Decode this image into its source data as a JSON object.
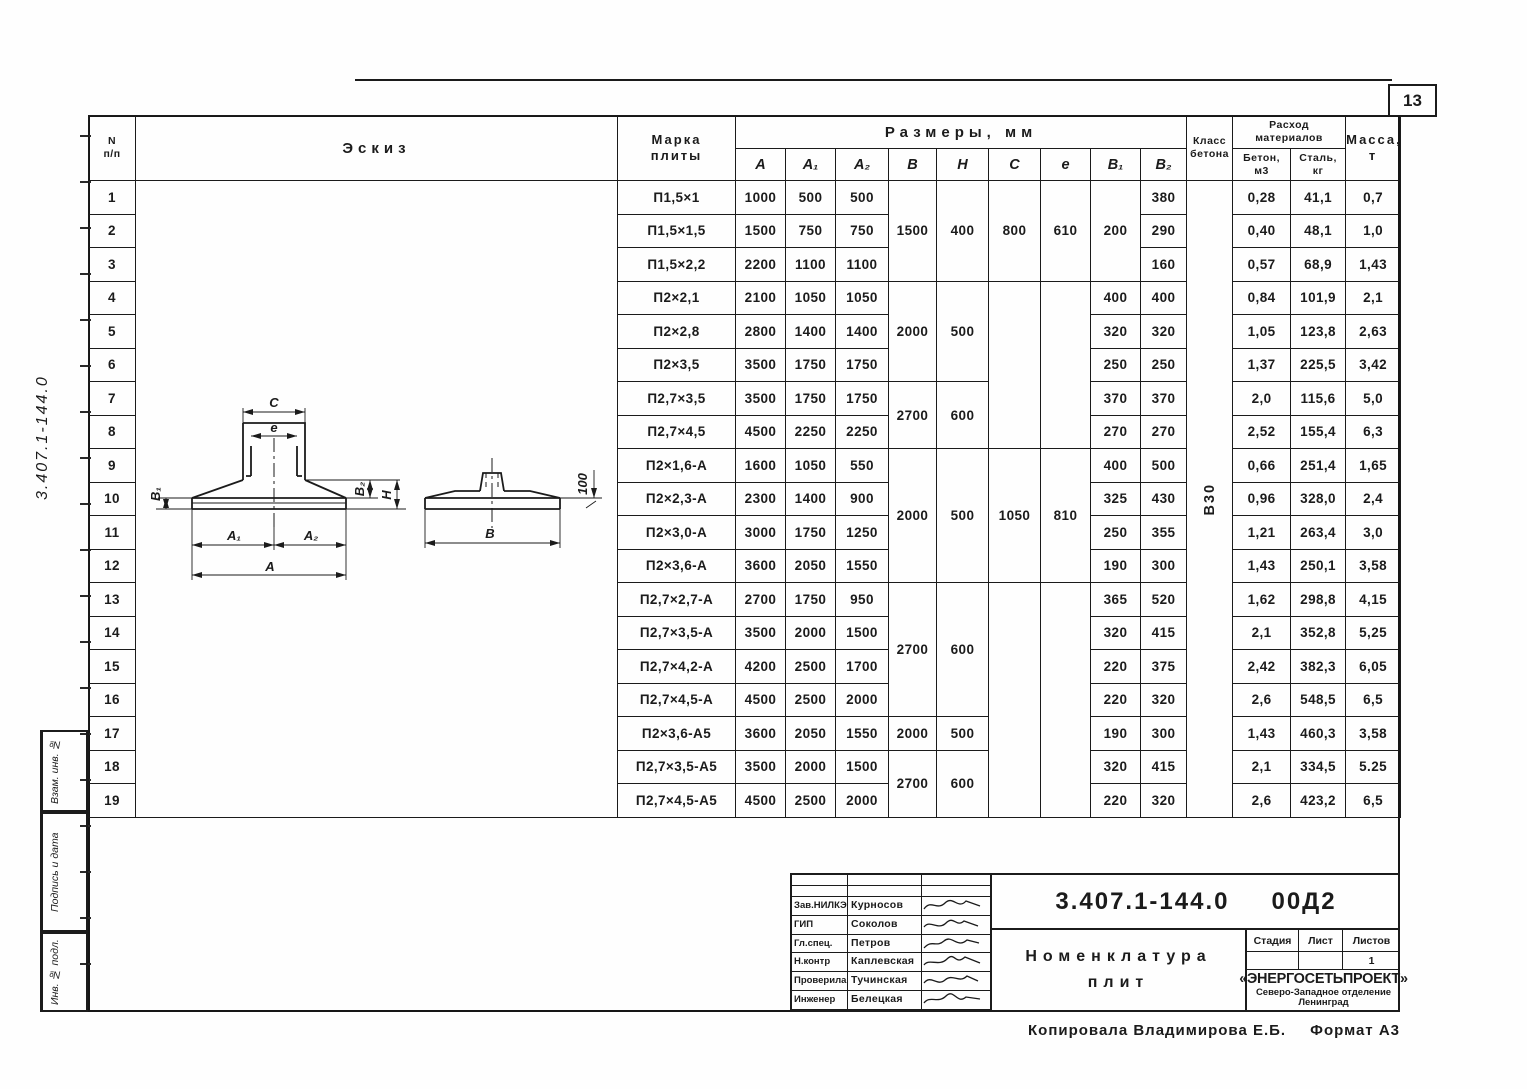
{
  "page": {
    "sheet_number": "13"
  },
  "margin": {
    "rotated_code": "3.407.1-144.0",
    "boxes": [
      "Взам. инв. №",
      "Подпись и дата",
      "Инв. № подл."
    ]
  },
  "table": {
    "header": {
      "num": [
        "N",
        "п/п"
      ],
      "sketch": "Эскиз",
      "mark": [
        "Марка",
        "плиты"
      ],
      "dims_group": "Размеры, мм",
      "dims": [
        "A",
        "A₁",
        "A₂",
        "B",
        "H",
        "C",
        "e",
        "B₁",
        "B₂"
      ],
      "concrete_class": [
        "Класс",
        "бетона"
      ],
      "materials_group": [
        "Расход",
        "материалов"
      ],
      "materials": [
        [
          "Бетон,",
          "м3"
        ],
        [
          "Сталь,",
          "кг"
        ]
      ],
      "mass": [
        "Масса,",
        "т"
      ]
    },
    "concrete_class_value": "В30",
    "rows": [
      {
        "n": "1",
        "mark": "П1,5×1",
        "cells": [
          [
            "1000"
          ],
          [
            "500"
          ],
          [
            "500"
          ],
          [
            "1500",
            3
          ],
          [
            "400",
            3
          ],
          [
            "800",
            3
          ],
          [
            "610",
            3
          ],
          [
            "200",
            3
          ],
          [
            "380"
          ],
          [
            "В30",
            19,
            "rot"
          ],
          [
            "0,28"
          ],
          [
            "41,1"
          ],
          [
            "0,7"
          ]
        ]
      },
      {
        "n": "2",
        "mark": "П1,5×1,5",
        "cells": [
          [
            "1500"
          ],
          [
            "750"
          ],
          [
            "750"
          ],
          [
            "290"
          ],
          [
            "0,40"
          ],
          [
            "48,1"
          ],
          [
            "1,0"
          ]
        ]
      },
      {
        "n": "3",
        "mark": "П1,5×2,2",
        "cells": [
          [
            "2200"
          ],
          [
            "1100"
          ],
          [
            "1100"
          ],
          [
            "160"
          ],
          [
            "0,57"
          ],
          [
            "68,9"
          ],
          [
            "1,43"
          ]
        ]
      },
      {
        "n": "4",
        "mark": "П2×2,1",
        "cells": [
          [
            "2100"
          ],
          [
            "1050"
          ],
          [
            "1050"
          ],
          [
            "2000",
            3
          ],
          [
            "500",
            3
          ],
          [
            "",
            5
          ],
          [
            "",
            5
          ],
          [
            "400"
          ],
          [
            "400"
          ],
          [
            "0,84"
          ],
          [
            "101,9"
          ],
          [
            "2,1"
          ]
        ]
      },
      {
        "n": "5",
        "mark": "П2×2,8",
        "cells": [
          [
            "2800"
          ],
          [
            "1400"
          ],
          [
            "1400"
          ],
          [
            "320"
          ],
          [
            "320"
          ],
          [
            "1,05"
          ],
          [
            "123,8"
          ],
          [
            "2,63"
          ]
        ]
      },
      {
        "n": "6",
        "mark": "П2×3,5",
        "cells": [
          [
            "3500"
          ],
          [
            "1750"
          ],
          [
            "1750"
          ],
          [
            "250"
          ],
          [
            "250"
          ],
          [
            "1,37"
          ],
          [
            "225,5"
          ],
          [
            "3,42"
          ]
        ]
      },
      {
        "n": "7",
        "mark": "П2,7×3,5",
        "cells": [
          [
            "3500"
          ],
          [
            "1750"
          ],
          [
            "1750"
          ],
          [
            "2700",
            2
          ],
          [
            "600",
            2
          ],
          [
            "370"
          ],
          [
            "370"
          ],
          [
            "2,0"
          ],
          [
            "115,6"
          ],
          [
            "5,0"
          ]
        ]
      },
      {
        "n": "8",
        "mark": "П2,7×4,5",
        "cells": [
          [
            "4500"
          ],
          [
            "2250"
          ],
          [
            "2250"
          ],
          [
            "270"
          ],
          [
            "270"
          ],
          [
            "2,52"
          ],
          [
            "155,4"
          ],
          [
            "6,3"
          ]
        ]
      },
      {
        "n": "9",
        "mark": "П2×1,6-А",
        "cells": [
          [
            "1600"
          ],
          [
            "1050"
          ],
          [
            "550"
          ],
          [
            "2000",
            4
          ],
          [
            "500",
            4
          ],
          [
            "1050",
            4
          ],
          [
            "810",
            4
          ],
          [
            "400"
          ],
          [
            "500"
          ],
          [
            "0,66"
          ],
          [
            "251,4"
          ],
          [
            "1,65"
          ]
        ]
      },
      {
        "n": "10",
        "mark": "П2×2,3-А",
        "cells": [
          [
            "2300"
          ],
          [
            "1400"
          ],
          [
            "900"
          ],
          [
            "325"
          ],
          [
            "430"
          ],
          [
            "0,96"
          ],
          [
            "328,0"
          ],
          [
            "2,4"
          ]
        ]
      },
      {
        "n": "11",
        "mark": "П2×3,0-А",
        "cells": [
          [
            "3000"
          ],
          [
            "1750"
          ],
          [
            "1250"
          ],
          [
            "250"
          ],
          [
            "355"
          ],
          [
            "1,21"
          ],
          [
            "263,4"
          ],
          [
            "3,0"
          ]
        ]
      },
      {
        "n": "12",
        "mark": "П2×3,6-А",
        "cells": [
          [
            "3600"
          ],
          [
            "2050"
          ],
          [
            "1550"
          ],
          [
            "190"
          ],
          [
            "300"
          ],
          [
            "1,43"
          ],
          [
            "250,1"
          ],
          [
            "3,58"
          ]
        ]
      },
      {
        "n": "13",
        "mark": "П2,7×2,7-А",
        "cells": [
          [
            "2700"
          ],
          [
            "1750"
          ],
          [
            "950"
          ],
          [
            "2700",
            4
          ],
          [
            "600",
            4
          ],
          [
            "",
            7
          ],
          [
            "",
            7
          ],
          [
            "365"
          ],
          [
            "520"
          ],
          [
            "1,62"
          ],
          [
            "298,8"
          ],
          [
            "4,15"
          ]
        ]
      },
      {
        "n": "14",
        "mark": "П2,7×3,5-А",
        "cells": [
          [
            "3500"
          ],
          [
            "2000"
          ],
          [
            "1500"
          ],
          [
            "320"
          ],
          [
            "415"
          ],
          [
            "2,1"
          ],
          [
            "352,8"
          ],
          [
            "5,25"
          ]
        ]
      },
      {
        "n": "15",
        "mark": "П2,7×4,2-А",
        "cells": [
          [
            "4200"
          ],
          [
            "2500"
          ],
          [
            "1700"
          ],
          [
            "220"
          ],
          [
            "375"
          ],
          [
            "2,42"
          ],
          [
            "382,3"
          ],
          [
            "6,05"
          ]
        ]
      },
      {
        "n": "16",
        "mark": "П2,7×4,5-А",
        "cells": [
          [
            "4500"
          ],
          [
            "2500"
          ],
          [
            "2000"
          ],
          [
            "220"
          ],
          [
            "320"
          ],
          [
            "2,6"
          ],
          [
            "548,5"
          ],
          [
            "6,5"
          ]
        ]
      },
      {
        "n": "17",
        "mark": "П2×3,6-А5",
        "cells": [
          [
            "3600"
          ],
          [
            "2050"
          ],
          [
            "1550"
          ],
          [
            "2000",
            1
          ],
          [
            "500",
            1
          ],
          [
            "190"
          ],
          [
            "300"
          ],
          [
            "1,43"
          ],
          [
            "460,3"
          ],
          [
            "3,58"
          ]
        ]
      },
      {
        "n": "18",
        "mark": "П2,7×3,5-А5",
        "cells": [
          [
            "3500"
          ],
          [
            "2000"
          ],
          [
            "1500"
          ],
          [
            "2700",
            2
          ],
          [
            "600",
            2
          ],
          [
            "320"
          ],
          [
            "415"
          ],
          [
            "2,1"
          ],
          [
            "334,5"
          ],
          [
            "5.25"
          ]
        ]
      },
      {
        "n": "19",
        "mark": "П2,7×4,5-А5",
        "cells": [
          [
            "4500"
          ],
          [
            "2500"
          ],
          [
            "2000"
          ],
          [
            "220"
          ],
          [
            "320"
          ],
          [
            "2,6"
          ],
          [
            "423,2"
          ],
          [
            "6,5"
          ]
        ]
      }
    ]
  },
  "sketch_labels": {
    "c": "C",
    "e": "e",
    "a1": "A₁",
    "a2": "A₂",
    "a": "A",
    "b1": "B₁",
    "b2": "B₂",
    "h": "H",
    "b": "B",
    "edge": "100"
  },
  "title_block": {
    "doc_number": "3.407.1-144.0",
    "doc_suffix": "00Д2",
    "title_lines": [
      "Номенклатура",
      "плит"
    ],
    "signatures": [
      {
        "role": "Зав.НИЛКЭ",
        "name": "Курносов"
      },
      {
        "role": "ГИП",
        "name": "Соколов"
      },
      {
        "role": "Гл.спец.",
        "name": "Петров"
      },
      {
        "role": "Н.контр",
        "name": "Каплевская"
      },
      {
        "role": "Проверила",
        "name": "Тучинская"
      },
      {
        "role": "Инженер",
        "name": "Белецкая"
      }
    ],
    "stage_headers": [
      "Стадия",
      "Лист",
      "Листов"
    ],
    "stage_values": [
      "",
      "",
      "1"
    ],
    "org_name": "«ЭНЕРГОСЕТЬПРОЕКТ»",
    "org_branch": "Северо-Западное отделение",
    "org_city": "Ленинград"
  },
  "footer": {
    "copied_by": "Копировала  Владимирова Е.Б.",
    "format": "Формат А3"
  }
}
